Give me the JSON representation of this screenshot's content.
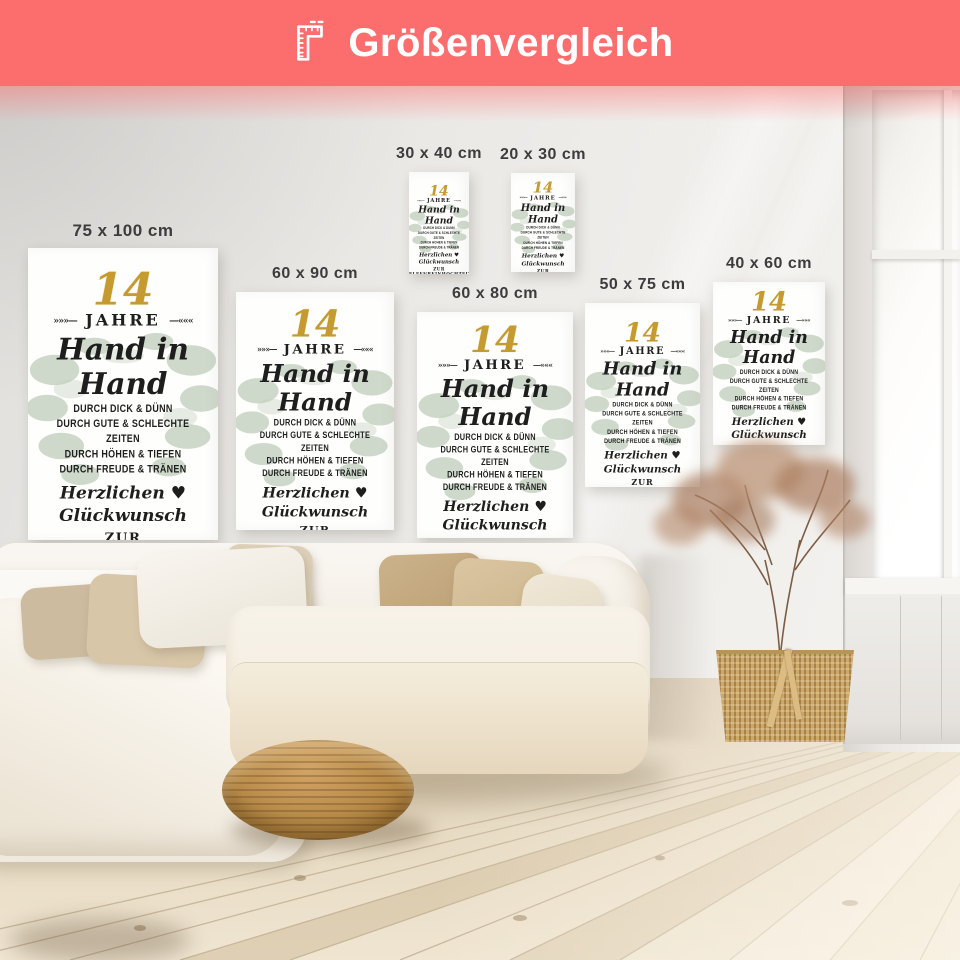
{
  "header": {
    "title": "Größenvergleich",
    "icon": "ruler-icon",
    "bg_color": "#fc6e6e"
  },
  "posters": {
    "design": {
      "number": "14",
      "jahre": "JAHRE",
      "flourish_left": "»»»—",
      "flourish_right": "—«««",
      "title": "Hand in Hand",
      "line1": "DURCH DICK & DÜNN",
      "line2": "DURCH GUTE & SCHLECHTE ZEITEN",
      "line3": "DURCH HÖHEN & TIEFEN",
      "line4": "DURCH FREUDE & TRÄNEN",
      "congrats": "Herzlichen ♥ Glückwunsch",
      "occasion": "ZUR ELFENBEINHOCHZEIT",
      "name_left": "ANDREAS",
      "name_right": "MARIANNE",
      "date_left": "10.05.1994",
      "date_separator": "♥",
      "date_right": "10.05.2024",
      "gold_color": "#c59b2f",
      "text_color": "#1e1e1e",
      "greenery_color": "#9eb49c"
    },
    "sizes": [
      {
        "label": "75 x 100 cm"
      },
      {
        "label": "60 x 90 cm"
      },
      {
        "label": "30 x 40 cm"
      },
      {
        "label": "20 x 30 cm"
      },
      {
        "label": "60 x 80 cm"
      },
      {
        "label": "50 x 75 cm"
      },
      {
        "label": "40 x 60 cm"
      }
    ]
  }
}
